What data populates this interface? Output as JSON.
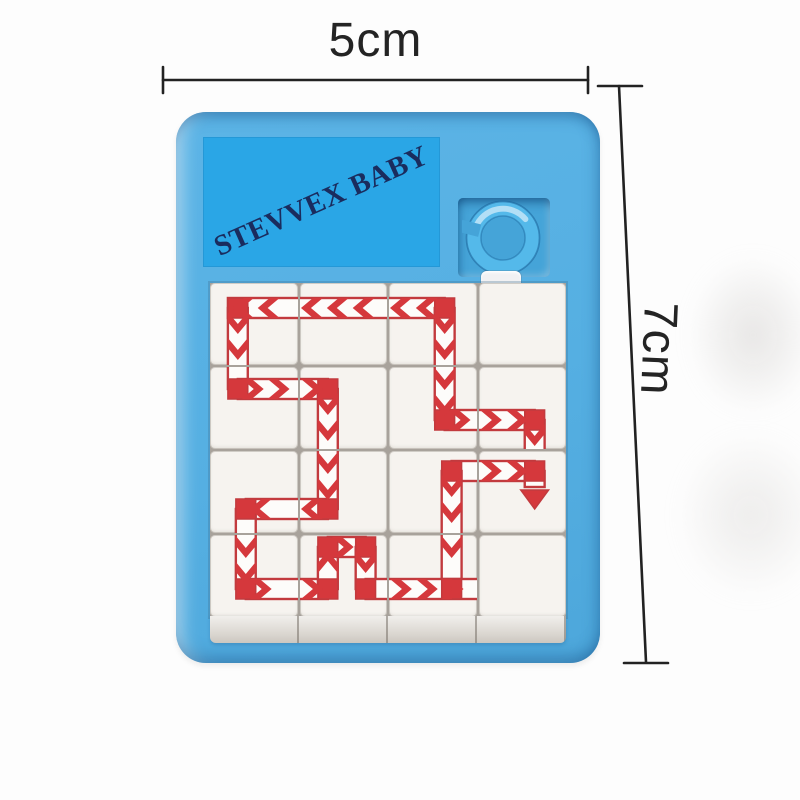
{
  "image_type": "product-photo of a slide puzzle keychain toy",
  "brand": {
    "watermark_text": "STEVVEX BABY"
  },
  "dimensions": {
    "width": {
      "label": "5cm"
    },
    "height": {
      "label": "7cm"
    }
  },
  "colors": {
    "frame_blue": "#5cb4e6",
    "watermark_blue": "#2aa6e6",
    "brand_text_navy": "#1a2c5e",
    "recess_blue": "#45a4d8",
    "ring_blue": "#54b9ea",
    "tile_white": "#f6f3ef",
    "path_red": "#d5383c",
    "path_outline_red": "#c23a3e",
    "dimension_line": "#222222"
  },
  "puzzle": {
    "rows": 4,
    "cols": 4,
    "description": "white sliding tiles printed with red striped arrow path segments; blue keychain ring in top-right recess; one tile tab raised above the board",
    "tiles": [
      {
        "id": "r1c1",
        "row": 1,
        "col": 1,
        "segments": [
          [
            "h",
            18,
            91,
            25,
            "l"
          ],
          [
            "c",
            28,
            25
          ],
          [
            "v",
            25,
            85,
            28,
            "d"
          ]
        ]
      },
      {
        "id": "r1c2",
        "row": 1,
        "col": 2,
        "segments": [
          [
            "h",
            -3,
            91,
            25,
            "l"
          ]
        ]
      },
      {
        "id": "r1c3",
        "row": 1,
        "col": 3,
        "segments": [
          [
            "h",
            -3,
            56,
            25,
            "l"
          ],
          [
            "c",
            56,
            25
          ],
          [
            "v",
            25,
            85,
            56,
            "d"
          ]
        ]
      },
      {
        "id": "r1c4",
        "row": 1,
        "col": 4,
        "segments": []
      },
      {
        "id": "r2c1",
        "row": 2,
        "col": 1,
        "segments": [
          [
            "v",
            -3,
            22,
            28,
            "d"
          ],
          [
            "c",
            28,
            22
          ],
          [
            "h",
            28,
            91,
            22,
            "r"
          ]
        ]
      },
      {
        "id": "r2c2",
        "row": 2,
        "col": 2,
        "segments": [
          [
            "h",
            -3,
            28,
            22,
            "r"
          ],
          [
            "c",
            28,
            22
          ],
          [
            "v",
            22,
            85,
            28,
            "d"
          ]
        ]
      },
      {
        "id": "r2c3",
        "row": 2,
        "col": 3,
        "segments": [
          [
            "v",
            -3,
            53,
            56,
            "d"
          ],
          [
            "c",
            56,
            53
          ],
          [
            "h",
            56,
            91,
            53,
            "r"
          ]
        ]
      },
      {
        "id": "r2c4",
        "row": 2,
        "col": 4,
        "segments": [
          [
            "h",
            -3,
            56,
            53,
            "r"
          ],
          [
            "c",
            56,
            53
          ],
          [
            "v",
            53,
            84,
            56,
            "d"
          ]
        ]
      },
      {
        "id": "r3c1",
        "row": 3,
        "col": 1,
        "segments": [
          [
            "h",
            36,
            91,
            58,
            "l"
          ],
          [
            "c",
            36,
            58
          ],
          [
            "v",
            58,
            85,
            36,
            "d"
          ]
        ]
      },
      {
        "id": "r3c2",
        "row": 3,
        "col": 2,
        "segments": [
          [
            "v",
            -3,
            58,
            28,
            "d"
          ],
          [
            "c",
            28,
            58
          ],
          [
            "h",
            -3,
            28,
            58,
            "l"
          ]
        ]
      },
      {
        "id": "r3c3",
        "row": 3,
        "col": 3,
        "segments": [
          [
            "h",
            63,
            91,
            20,
            "r"
          ],
          [
            "c",
            63,
            20
          ],
          [
            "v",
            20,
            85,
            63,
            "d"
          ]
        ]
      },
      {
        "id": "r3c4",
        "row": 3,
        "col": 4,
        "segments": [
          [
            "h",
            -3,
            56,
            20,
            "r"
          ],
          [
            "c",
            56,
            20
          ],
          [
            "v",
            20,
            36,
            56,
            "d"
          ],
          [
            "end",
            56,
            46,
            "d"
          ]
        ]
      },
      {
        "id": "r4c1",
        "row": 4,
        "col": 1,
        "segments": [
          [
            "v",
            -3,
            54,
            36,
            "d"
          ],
          [
            "c",
            36,
            54
          ],
          [
            "h",
            36,
            91,
            54,
            "r"
          ]
        ]
      },
      {
        "id": "r4c2",
        "row": 4,
        "col": 2,
        "segments": [
          [
            "h",
            -3,
            28,
            54,
            "r"
          ],
          [
            "c",
            28,
            54
          ],
          [
            "v",
            12,
            54,
            28,
            "u"
          ],
          [
            "c",
            28,
            12
          ],
          [
            "h",
            28,
            66,
            12,
            "r"
          ],
          [
            "c",
            66,
            12
          ],
          [
            "v",
            12,
            54,
            66,
            "d"
          ],
          [
            "c",
            66,
            54
          ],
          [
            "h",
            66,
            91,
            54,
            "r"
          ]
        ]
      },
      {
        "id": "r4c3",
        "row": 4,
        "col": 3,
        "segments": [
          [
            "v",
            -3,
            44,
            63,
            "d"
          ],
          [
            "c",
            63,
            54
          ],
          [
            "h",
            -3,
            91,
            54,
            "r"
          ]
        ]
      },
      {
        "id": "r4c4",
        "row": 4,
        "col": 4,
        "segments": []
      }
    ]
  }
}
